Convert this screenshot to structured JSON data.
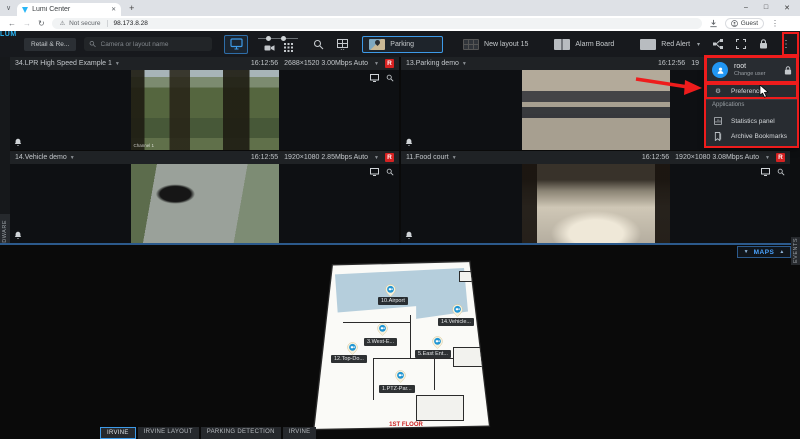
{
  "colors": {
    "accent_blue": "#3d9ae8",
    "record_red": "#d62222",
    "annotation_red": "#ee1c1c",
    "avatar_blue": "#2196f3",
    "maps_blue": "#4aa3ff",
    "floor_label_red": "#cc2222"
  },
  "browser": {
    "tab": {
      "title": "Lumi Center"
    },
    "address": {
      "security": "Not secure",
      "url": "98.173.8.28"
    },
    "profile": "Guest"
  },
  "toolbar": {
    "logo": "LUMI",
    "group_button": "Retail & Re...",
    "search_placeholder": "Camera or layout name",
    "layout_tabs": [
      {
        "label": "Parking",
        "active": true
      },
      {
        "label": "New layout 15",
        "active": false
      },
      {
        "label": "Alarm Board",
        "active": false
      },
      {
        "label": "Red Alert",
        "active": false
      }
    ]
  },
  "cameras": [
    {
      "name": "34.LPR High Speed Example 1",
      "time": "16:12:56",
      "stream": "2688×1520 3.00Mbps Auto",
      "rec": "R",
      "watermark": "Channel 1"
    },
    {
      "name": "13.Parking demo",
      "time": "16:12:56",
      "stream": "19"
    },
    {
      "name": "14.Vehicle demo",
      "time": "16:12:55",
      "stream": "1920×1080 2.85Mbps Auto",
      "rec": "R"
    },
    {
      "name": "11.Food court",
      "time": "16:12:56",
      "stream": "1920×1080 3.08Mbps Auto",
      "rec": "R"
    }
  ],
  "user_menu": {
    "user_name": "root",
    "change_user": "Change user",
    "preferences": "Preferences",
    "section_title": "Applications",
    "apps": [
      {
        "label": "Statistics panel"
      },
      {
        "label": "Archive Bookmarks"
      }
    ]
  },
  "panels": {
    "maps_label": "MAPS",
    "left_vertical": "HARDWARE",
    "right_vertical": "EVENTS"
  },
  "map": {
    "floor_label": "1ST FLOOR",
    "pins": [
      {
        "label": "10.Airport"
      },
      {
        "label": "14.Vehicle..."
      },
      {
        "label": "3.West-E..."
      },
      {
        "label": "12.Top-Do..."
      },
      {
        "label": "5.East Ent..."
      },
      {
        "label": "1.PTZ-Par..."
      }
    ]
  },
  "bottom_tabs": [
    {
      "label": "IRVINE",
      "active": true
    },
    {
      "label": "IRVINE LAYOUT",
      "active": false
    },
    {
      "label": "PARKING DETECTION",
      "active": false
    },
    {
      "label": "IRVINE",
      "active": false
    }
  ]
}
